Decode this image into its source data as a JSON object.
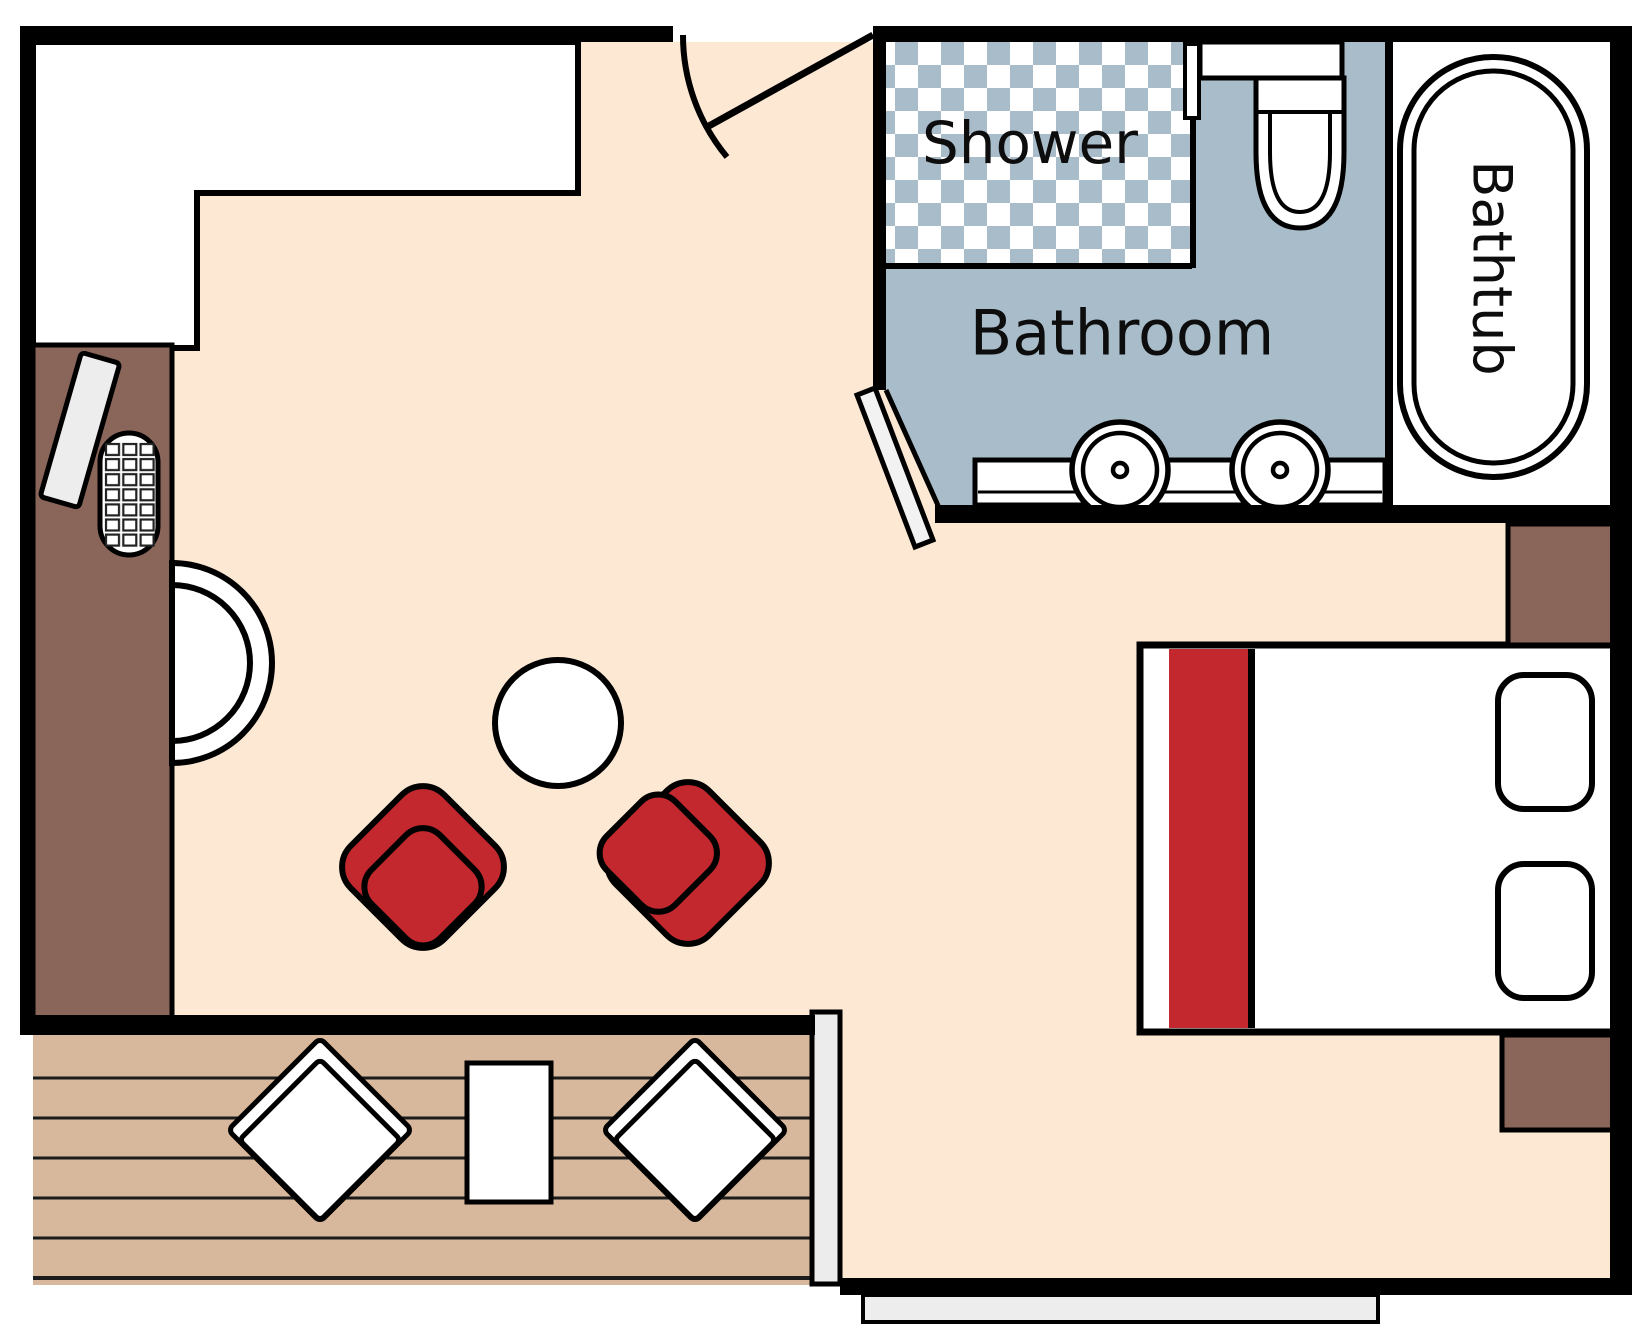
{
  "labels": {
    "shower": "Shower",
    "bathroom": "Bathroom",
    "bathtub": "Bathtub"
  },
  "colors": {
    "floor": "#fde8d4",
    "wall": "#000000",
    "outline": "#000000",
    "bathroom-blue": "#a9bcca",
    "checker-white": "#ffffff",
    "wardrobe-brown": "#8a655a",
    "deck-tan": "#d7b89c",
    "chair-red": "#c2282e",
    "door-gray": "#ececec",
    "step-gray": "#ededed",
    "fixture-white": "#ffffff"
  },
  "fixtures": [
    "entry-door",
    "closet-nook",
    "wardrobe-strip",
    "ironing-board",
    "luggage-rack",
    "round-chair",
    "coffee-table",
    "red-armchair-left",
    "red-armchair-right",
    "shower",
    "bathroom-floor",
    "bathroom-door",
    "toilet",
    "vanity-counter",
    "sink-left",
    "sink-right",
    "bathtub",
    "bed",
    "bed-runner",
    "pillow-top",
    "pillow-bottom",
    "nightstand-top",
    "nightstand-bottom",
    "terrace-deck",
    "deck-lounger-left",
    "deck-lounger-right",
    "deck-table",
    "sliding-door",
    "entry-step"
  ]
}
